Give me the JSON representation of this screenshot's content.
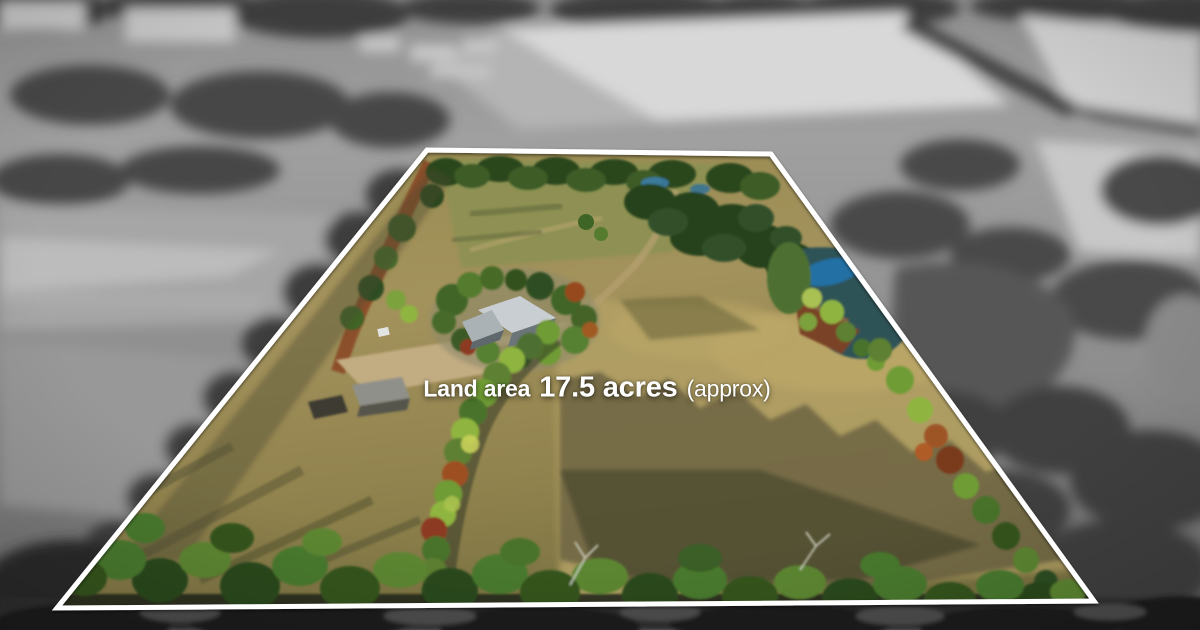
{
  "overlay": {
    "prefix": "Land area",
    "value": "17.5 acres",
    "qualifier": "(approx)"
  },
  "boundary": {
    "points": "427,150 771,154 1094,601 57,608",
    "stroke_width": 5
  },
  "palette": {
    "boundary_stroke": "#ffffff",
    "overlay_text": "#ffffff",
    "pasture_tan": "#a3925c",
    "pasture_sunlit": "#b8a468",
    "shadow_olive": "#45422c",
    "tree_dark_green": "#2c461f",
    "tree_mid_green": "#4a7a2e",
    "hedge_lime": "#8fb541",
    "autumn_rust": "#9e4f24",
    "dam_teal": "#2f5257",
    "dam_blue": "#2470a4",
    "roof_light_gray": "#c9ced2",
    "roof_dark_gray": "#6b757a",
    "driveway_gravel": "#c2ac82",
    "dirt_red": "#8a4a28",
    "bw_field_light": "#d8d8d8",
    "bw_midtone": "#9a9a9a",
    "bw_tree_dark": "#3c3c3c"
  }
}
